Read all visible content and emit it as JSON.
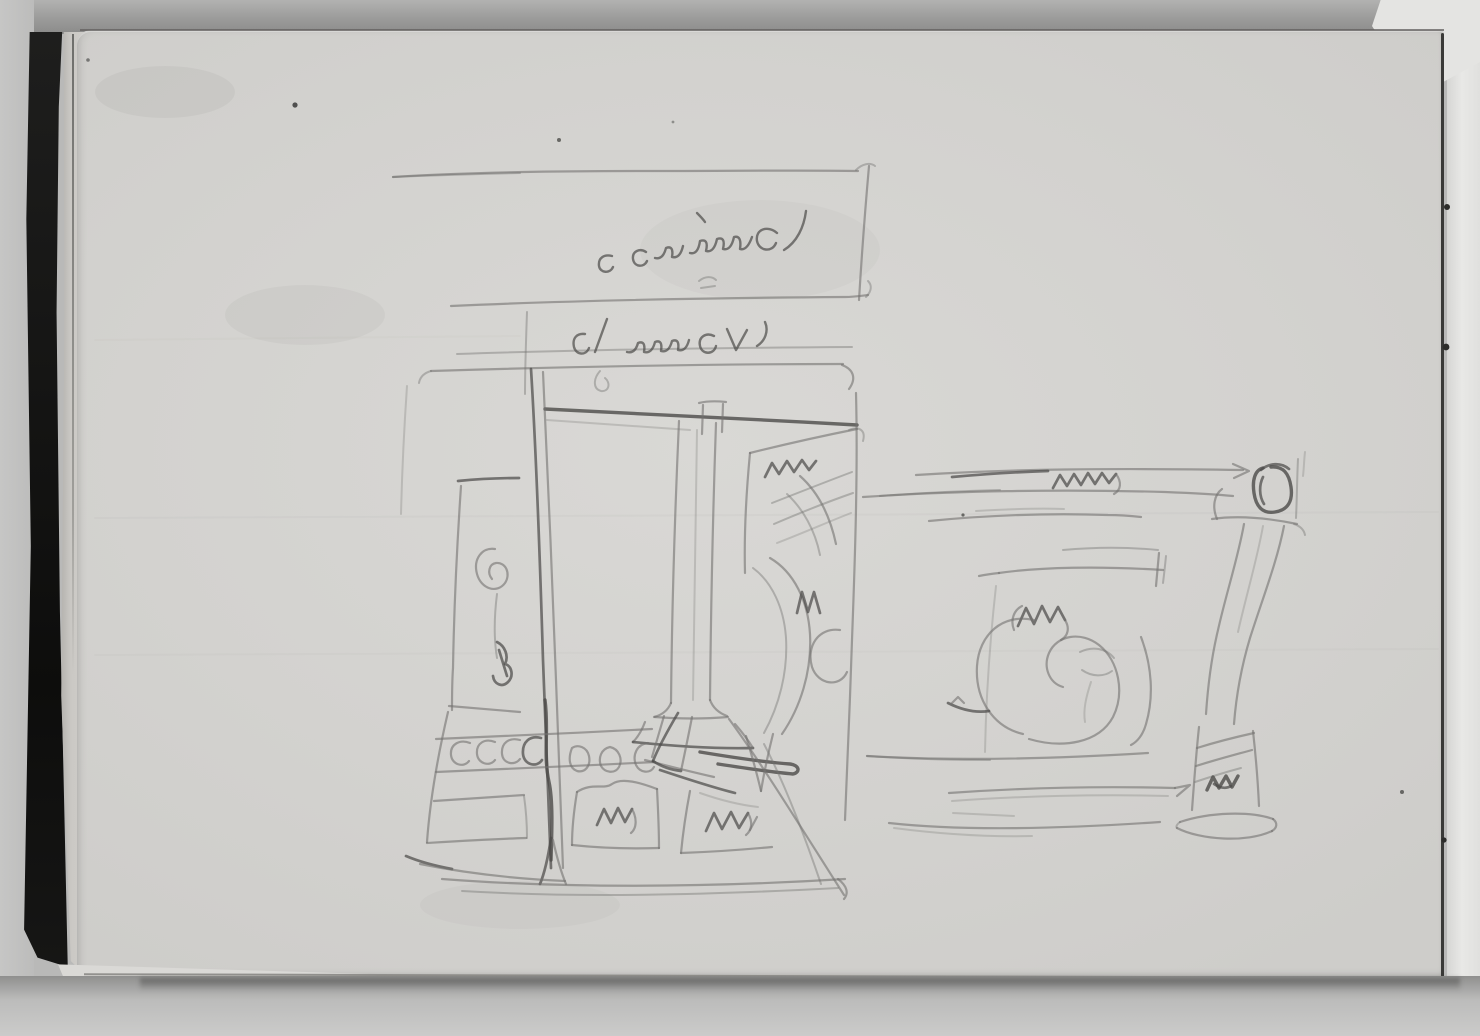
{
  "meta": {
    "title": "Sketchbook page: two graphite studies of chimneypieces",
    "medium": "graphite pencil on pale gray wove sketchbook paper",
    "setting": "photograph of an open sketchbook; dark board cover along left spine, edge of following leaf visible at right, gray backdrop around the block",
    "page_number_visible": false,
    "typed_text_visible": false
  },
  "palette": {
    "backdrop": "#b9b9b8",
    "paper": "#d3d2cf",
    "paper_highlight": "#d9d8d5",
    "spine": "#141413",
    "next_page": "#e8e8e6",
    "pencil": "#73726f",
    "pencil_dark": "#4c4b49",
    "edge_line": "#3a3a38"
  },
  "figures": [
    {
      "id": "left-study",
      "subject": "Frontal elevation of a chimneypiece/portal: cornice band with inscriptions, paneled jambs with scroll ornament, central tapering column on plinth, band of circular guilloche ornament, squiggle-marked base panels, long diagonal construction strokes toward lower right",
      "position": "left half of page"
    },
    {
      "id": "right-study",
      "subject": "Profile study of a mantel shelf: long cornice lines with zigzag scribble, square rosette block over an S-curved console leg ending in a hatched foot block on a shallow base, frieze panel filled with C-scrolls",
      "position": "right half of page, slightly lower"
    }
  ],
  "inscriptions": [
    {
      "id": "upper",
      "legibility": "illegible",
      "description": "inverted cursive handwriting between the two top cornice lines (written from the other end of the book)"
    },
    {
      "id": "lower",
      "legibility": "illegible",
      "description": "second inverted cursive word between the lower cornice lines"
    }
  ],
  "aria": {
    "scene": "Photograph of an open sketchbook page bearing two faint pencil sketches of chimneypieces, with dark cover spine at left",
    "left_figure": "Pencil elevation sketch of a chimneypiece with central column, scroll panels and ornament bands",
    "right_figure": "Pencil profile sketch of a mantel shelf with rosette block, console leg and scrolled frieze",
    "inscription_upper": "Inverted illegible cursive inscription in cornice band",
    "inscription_lower": "Second inverted illegible cursive inscription below"
  }
}
